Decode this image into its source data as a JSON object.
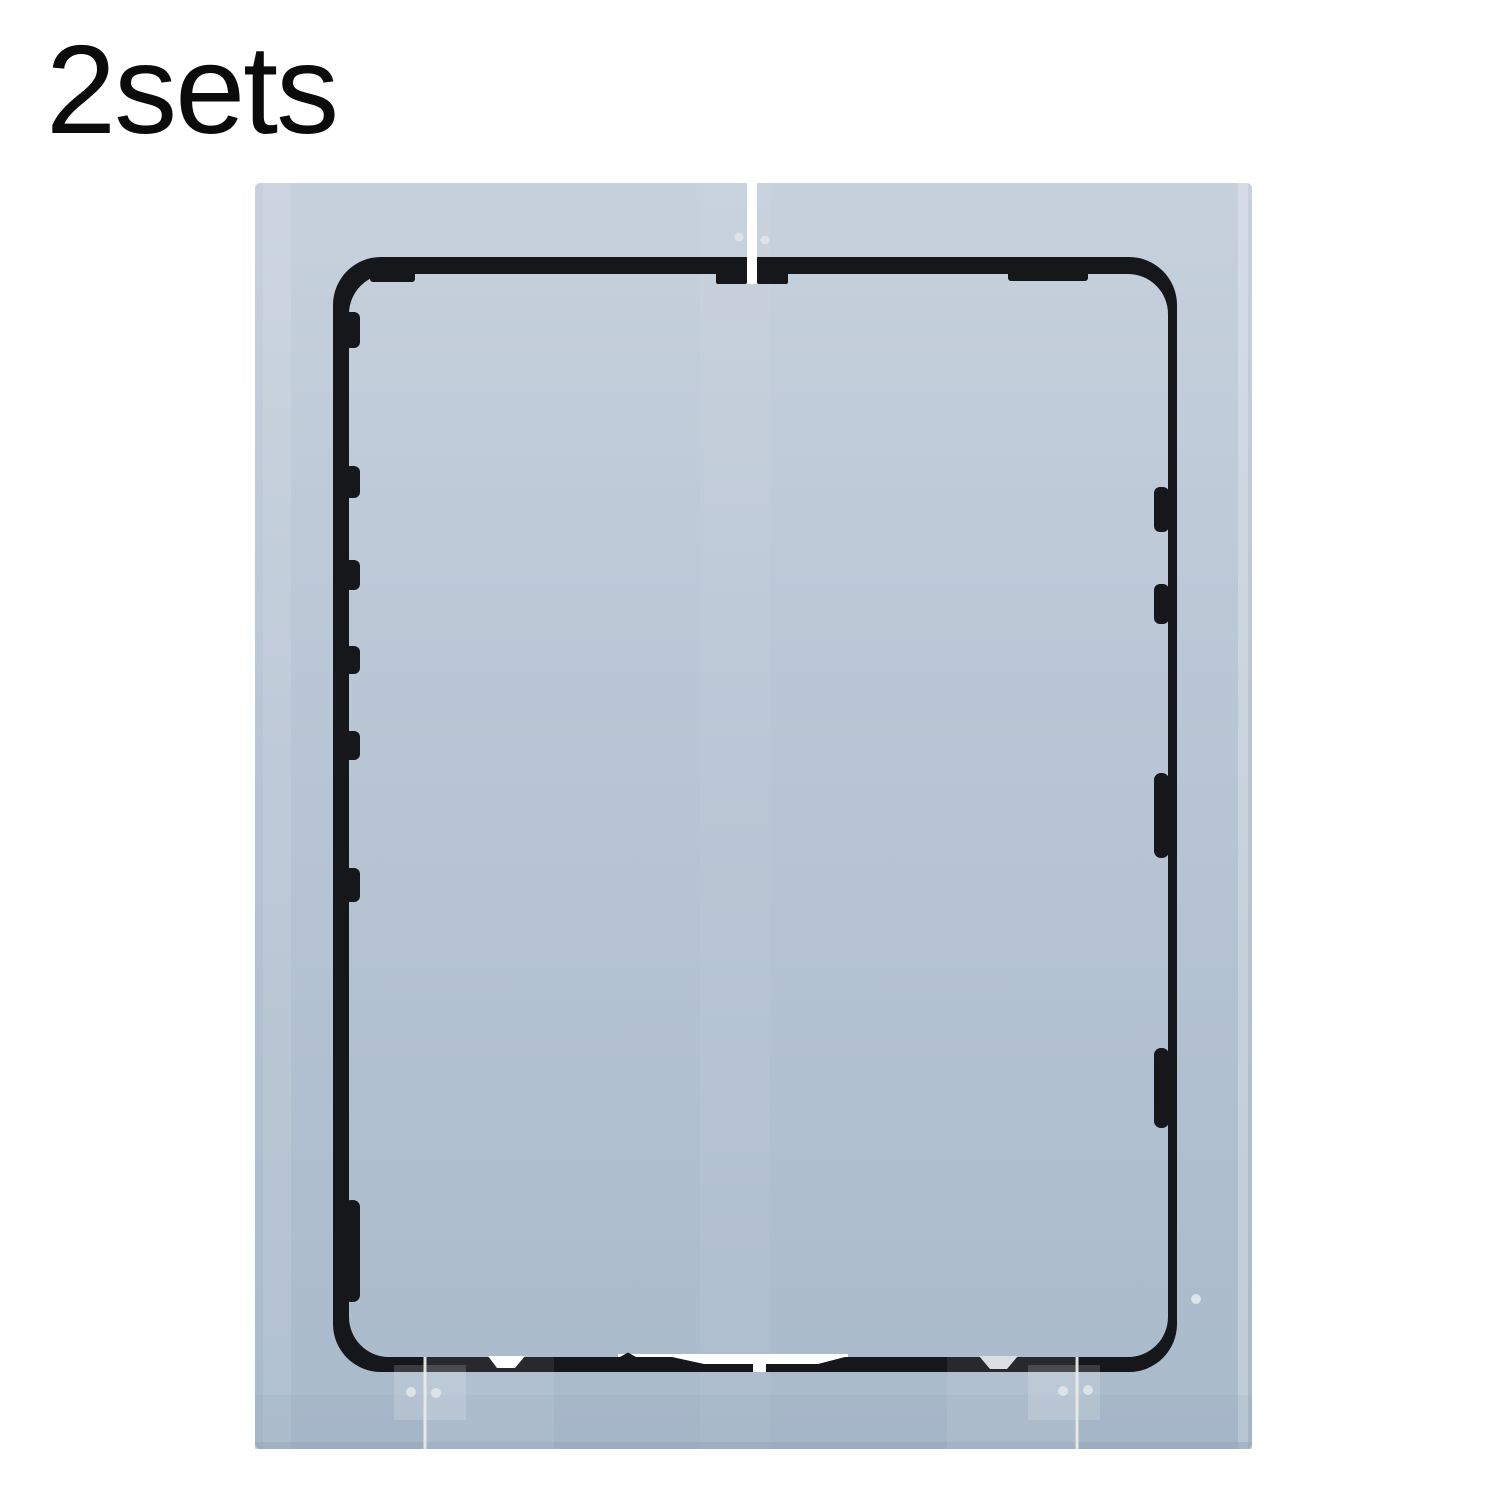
{
  "label": {
    "quantity": "2sets"
  },
  "photo": {
    "subject": "two-piece tablet screen frame adhesive sticker set",
    "colors": {
      "background": "#ffffff",
      "label_text": "#0b0b0b",
      "liner_top": "#c7d1dd",
      "liner_mid": "#b8c5d4",
      "liner_bottom": "#a9bacb",
      "liner_shade": "#8fa3b6",
      "adhesive_black": "#15171b",
      "cutout_white": "#ffffff",
      "notch_gray": "#d8dde2",
      "seam_light": "#e8ebe7",
      "hole_dot": "#dde3e8"
    }
  }
}
